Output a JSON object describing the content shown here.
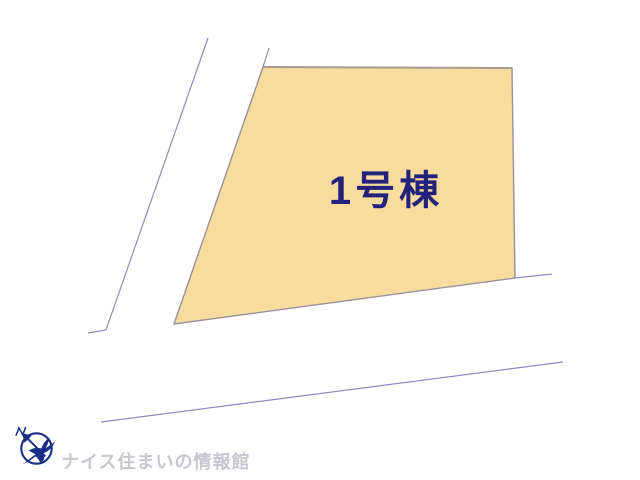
{
  "page": {
    "width": 640,
    "height": 480,
    "background_color": "#ffffff"
  },
  "site_plan": {
    "lot": {
      "label": "1号棟",
      "label_color": "#22227c",
      "fill": "#f8dc9e",
      "stroke": "#97919d",
      "top_edge_color": "#a69c8f",
      "points": [
        [
          263,
          67
        ],
        [
          512,
          68
        ],
        [
          515,
          278
        ],
        [
          174,
          324
        ]
      ]
    },
    "road_color": "#8d8ac1",
    "road_lines": [
      {
        "name": "left-road-outer-edge",
        "points": [
          [
            208,
            38
          ],
          [
            106,
            330
          ],
          [
            88,
            333
          ]
        ]
      },
      {
        "name": "left-road-inner-edge",
        "points": [
          [
            269,
            48
          ],
          [
            263,
            67
          ]
        ]
      },
      {
        "name": "lot-bottom-boundary-extension",
        "points": [
          [
            515,
            278
          ],
          [
            552,
            274
          ]
        ]
      },
      {
        "name": "lower-road-edge",
        "points": [
          [
            101,
            422
          ],
          [
            563,
            362
          ]
        ]
      }
    ]
  },
  "footer": {
    "brand_text": "ナイス住まいの情報館",
    "brand_text_color": "#c7c7cf",
    "logo_color": "#1c2f86"
  }
}
